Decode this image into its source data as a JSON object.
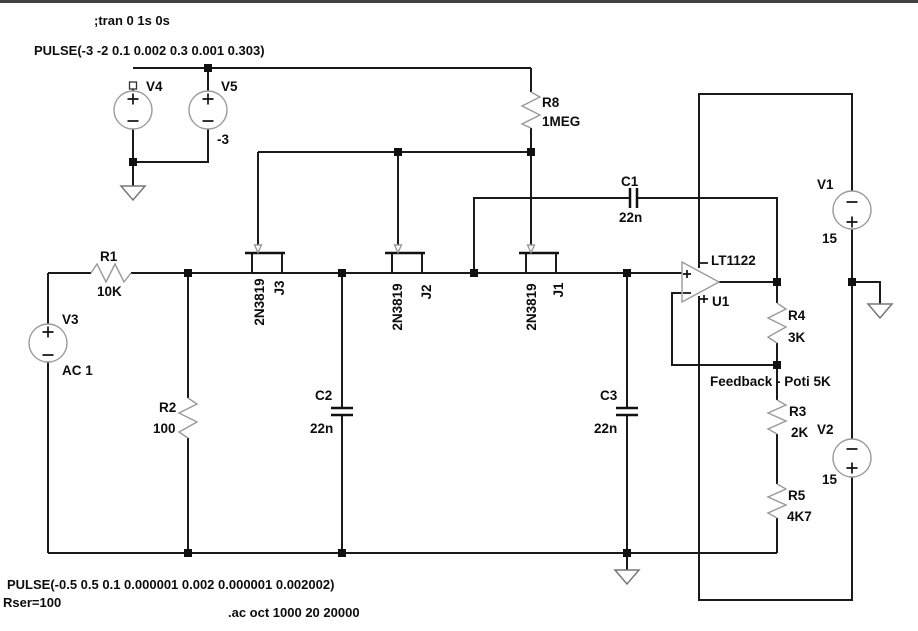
{
  "window": {
    "background": "#ffffff",
    "top_border_color": "#414141"
  },
  "directives": {
    "tran": ";tran 0 1s 0s",
    "pulse_top": "PULSE(-3 -2 0.1 0.002 0.3 0.001 0.303)",
    "pulse_bottom": "PULSE(-0.5 0.5 0.1 0.000001 0.002 0.000001 0.002002)",
    "rser": "Rser=100",
    "ac": ".ac oct 1000 20 20000"
  },
  "components": {
    "v1": {
      "name": "V1",
      "value": "15"
    },
    "v2": {
      "name": "V2",
      "value": "15"
    },
    "v3": {
      "name": "V3",
      "value": "AC 1"
    },
    "v4": {
      "name": "V4"
    },
    "v5": {
      "name": "V5",
      "value": "-3"
    },
    "r1": {
      "name": "R1",
      "value": "10K"
    },
    "r2": {
      "name": "R2",
      "value": "100"
    },
    "r3": {
      "name": "R3",
      "value": "2K"
    },
    "r4": {
      "name": "R4",
      "value": "3K"
    },
    "r5": {
      "name": "R5",
      "value": "4K7"
    },
    "r8": {
      "name": "R8",
      "value": "1MEG"
    },
    "c1": {
      "name": "C1",
      "value": "22n"
    },
    "c2": {
      "name": "C2",
      "value": "22n"
    },
    "c3": {
      "name": "C3",
      "value": "22n"
    },
    "j1": {
      "name": "J1",
      "model": "2N3819"
    },
    "j2": {
      "name": "J2",
      "model": "2N3819"
    },
    "j3": {
      "name": "J3",
      "model": "2N3819"
    },
    "u1": {
      "name": "U1",
      "model": "LT1122"
    }
  },
  "annotations": {
    "feedback_note": "Feedback - Poti 5K"
  },
  "colors": {
    "wire": "#1a1a1a",
    "component_outline": "#9a9a9a",
    "ground": "#777777",
    "text": "#0d0d0d"
  }
}
